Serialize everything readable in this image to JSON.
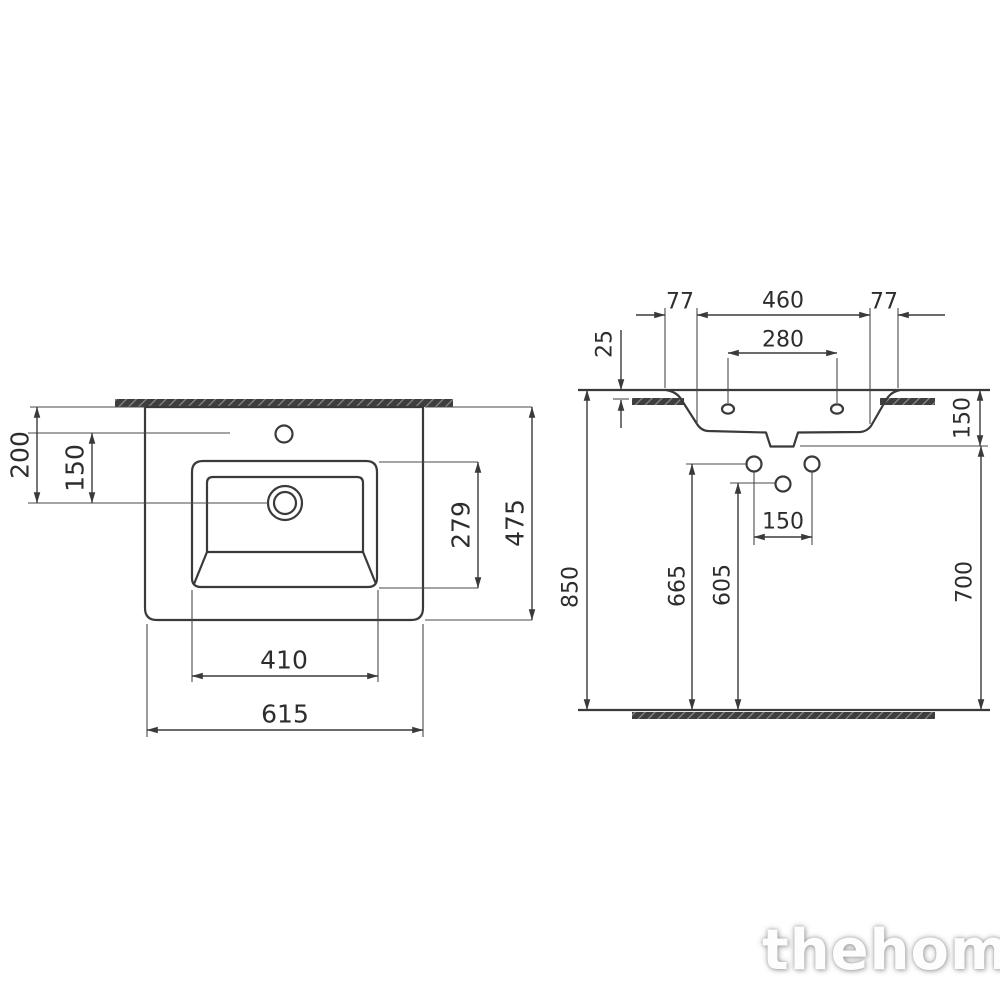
{
  "watermark": "thehome",
  "colors": {
    "line": "#3a3a3a",
    "text": "#2d2d2d",
    "hatch_fill": "#3e3e3e",
    "hatch_stripe": "#8a8a8a",
    "background": "#ffffff",
    "watermark": "#fdfdfd"
  },
  "plan_view": {
    "d200": "200",
    "d150": "150",
    "d279": "279",
    "d475": "475",
    "d410": "410",
    "d615": "615"
  },
  "front_view": {
    "d77_left": "77",
    "d460": "460",
    "d77_right": "77",
    "d280": "280",
    "d25": "25",
    "d150_side": "150",
    "d150_holes": "150",
    "d850": "850",
    "d665": "665",
    "d605": "605",
    "d700": "700"
  }
}
